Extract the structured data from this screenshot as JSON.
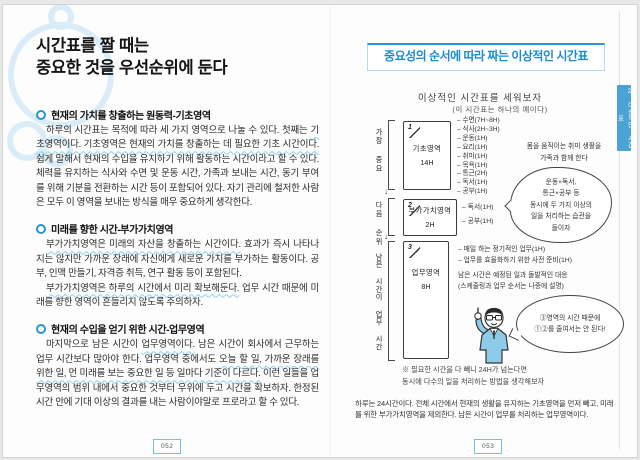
{
  "colors": {
    "accent_blue": "#2b96d4",
    "header_text_blue": "#1d8ccf",
    "tab_bg": "#4aa2d6",
    "wavy_underline": "#8ed0ee",
    "sketch_ink": "#3c3c3c",
    "suit_blue": "#8ecbe9",
    "watermark_blue": "#d9ecf8"
  },
  "left_page": {
    "title_lines": [
      "시간표를 짤 때는",
      "중요한 것을 우선순위에 둔다"
    ],
    "sections": [
      {
        "heading": "현재의 가치를 창출하는 원동력-기초영역",
        "paragraphs": [
          [
            {
              "t": "하루의 시간표는 목적에 따라 세 가지 영역으로 나눌 수 있다. 첫째는 ",
              "w": false
            },
            {
              "t": "기초영역이다. 기초영역은 현재의 가치를 창출하는 데 필요한 기초 시간이다.",
              "w": true
            },
            {
              "t": " 쉽게 말해서 현재의 수입을 유지하기 위해 활동하는 시간이라고 할 수 있다. 체력을 유지하는 식사와 수면 및 운동 시간, 가족과 보내는 시간, 동기 부여를 위해 기분을 전환하는 시간 등이 포함되어 있다. 자기 관리에 철저한 사람은 모두 이 영역을 보내는 방식을 매우 중요하게 생각한다.",
              "w": false
            }
          ]
        ]
      },
      {
        "heading": "미래를 향한 시간-부가가치영역",
        "paragraphs": [
          [
            {
              "t": "부가가치영역은 미래의 자산을 창출하는 시간이다.",
              "w": true
            },
            {
              "t": " 효과가 즉시 나타나지는 않지만 가까운 장래에 자신에게 새로운 가치를 부가하는 활동이다. 공부, 인맥 만들기, 자격증 취득, 연구 활동 등이 포함된다.",
              "w": false
            }
          ],
          [
            {
              "t": "부가가치영역은 하루의 시간에서 미리 확보해둔다.",
              "w": true
            },
            {
              "t": " 업무 시간 때문에 미래를 향한 영역이 흔들리지 않도록 주의하자.",
              "w": false
            }
          ]
        ]
      },
      {
        "heading": "현재의 수입을 얻기 위한 시간-업무영역",
        "paragraphs": [
          [
            {
              "t": "마지막으로 남은 시간이 ",
              "w": false
            },
            {
              "t": "업무영역이다.",
              "w": true
            },
            {
              "t": " 남은 시간이 회사에서 근무하는 업무 시간보다 많아야 한다. 업무영역 중에서도 ",
              "w": false
            },
            {
              "t": "오늘 할 일, 가까운 장래를 위한 일, 먼 미래를 보는 중요한 일 등 일마다 기준이 다르다.",
              "w": true
            },
            {
              "t": " 이런 일들을 업무영역의 범위 내에서 중요한 것부터 우위에 두고 시간을 확보하자. 한정된 시간 안에 기대 이상의 결과를 내는 사람이야말로 프로라고 할 수 있다.",
              "w": false
            }
          ]
        ]
      }
    ],
    "page_number": "052"
  },
  "right_page": {
    "header": "중요성의 순서에 따라 짜는 이상적인 시간표",
    "sketch_title": "이상적인 시간표를 세워보자",
    "sketch_subtitle": "(이 시간표는 하나의 예이다)",
    "side_tab": "2 이상적인 시간표",
    "arrow": "↓",
    "brackets": [
      "가장 중요",
      "다음 순위",
      "남은 시간이 업무 시간"
    ],
    "boxes": [
      {
        "num": "1",
        "label": "기초영역",
        "hours": "14H",
        "items": [
          "수면(7H~8H)",
          "식사(2H~3H)",
          "운동(1H)",
          "요리(1H)",
          "취미(1H)",
          "목욕(1H)",
          "통근(2H)",
          "독서(1H)",
          "공부(1H)"
        ]
      },
      {
        "num": "2",
        "label": "부가가치영역",
        "hours": "2H",
        "items": [
          "독서(1H)",
          "공부(1H)"
        ]
      },
      {
        "num": "3",
        "label": "업무영역",
        "hours": "8H",
        "items": [
          "매일 하는 정기적인 업무(1H)",
          "업무를 효율화하기 위한 사전 준비(1H)"
        ],
        "notes": [
          "남은 시간은 예정된 일과 돌발적인 대응",
          "(스케줄링과 업무 순서는 나중에 설명)"
        ]
      }
    ],
    "family_note": [
      "몸을 움직이는 취미 생활을",
      "가족과 함께 한다"
    ],
    "cloud_bubble": [
      "운동×독서,",
      "통근×공부 등",
      "동시에 두 가지 이상의",
      "일을 처리하는 습관을",
      "들이자"
    ],
    "speech_bubble": [
      "③영역의 시간 때문에",
      "①②를 줄여서는 안 된다!"
    ],
    "footnote": [
      "※ 필요한 시간을 다 빼니 24H가 넘는다면",
      "동시에 다수의 일을 처리하는 방법을 생각해보자"
    ],
    "caption": "하루는 24시간이다. 전체 시간에서 현재의 생활을 유지하는 기초영역을 먼저 빼고, 미래를 위한 부가가치영역을 제외한다. 남은 시간이 업무를 처리하는 업무영역이다.",
    "page_number": "053"
  }
}
